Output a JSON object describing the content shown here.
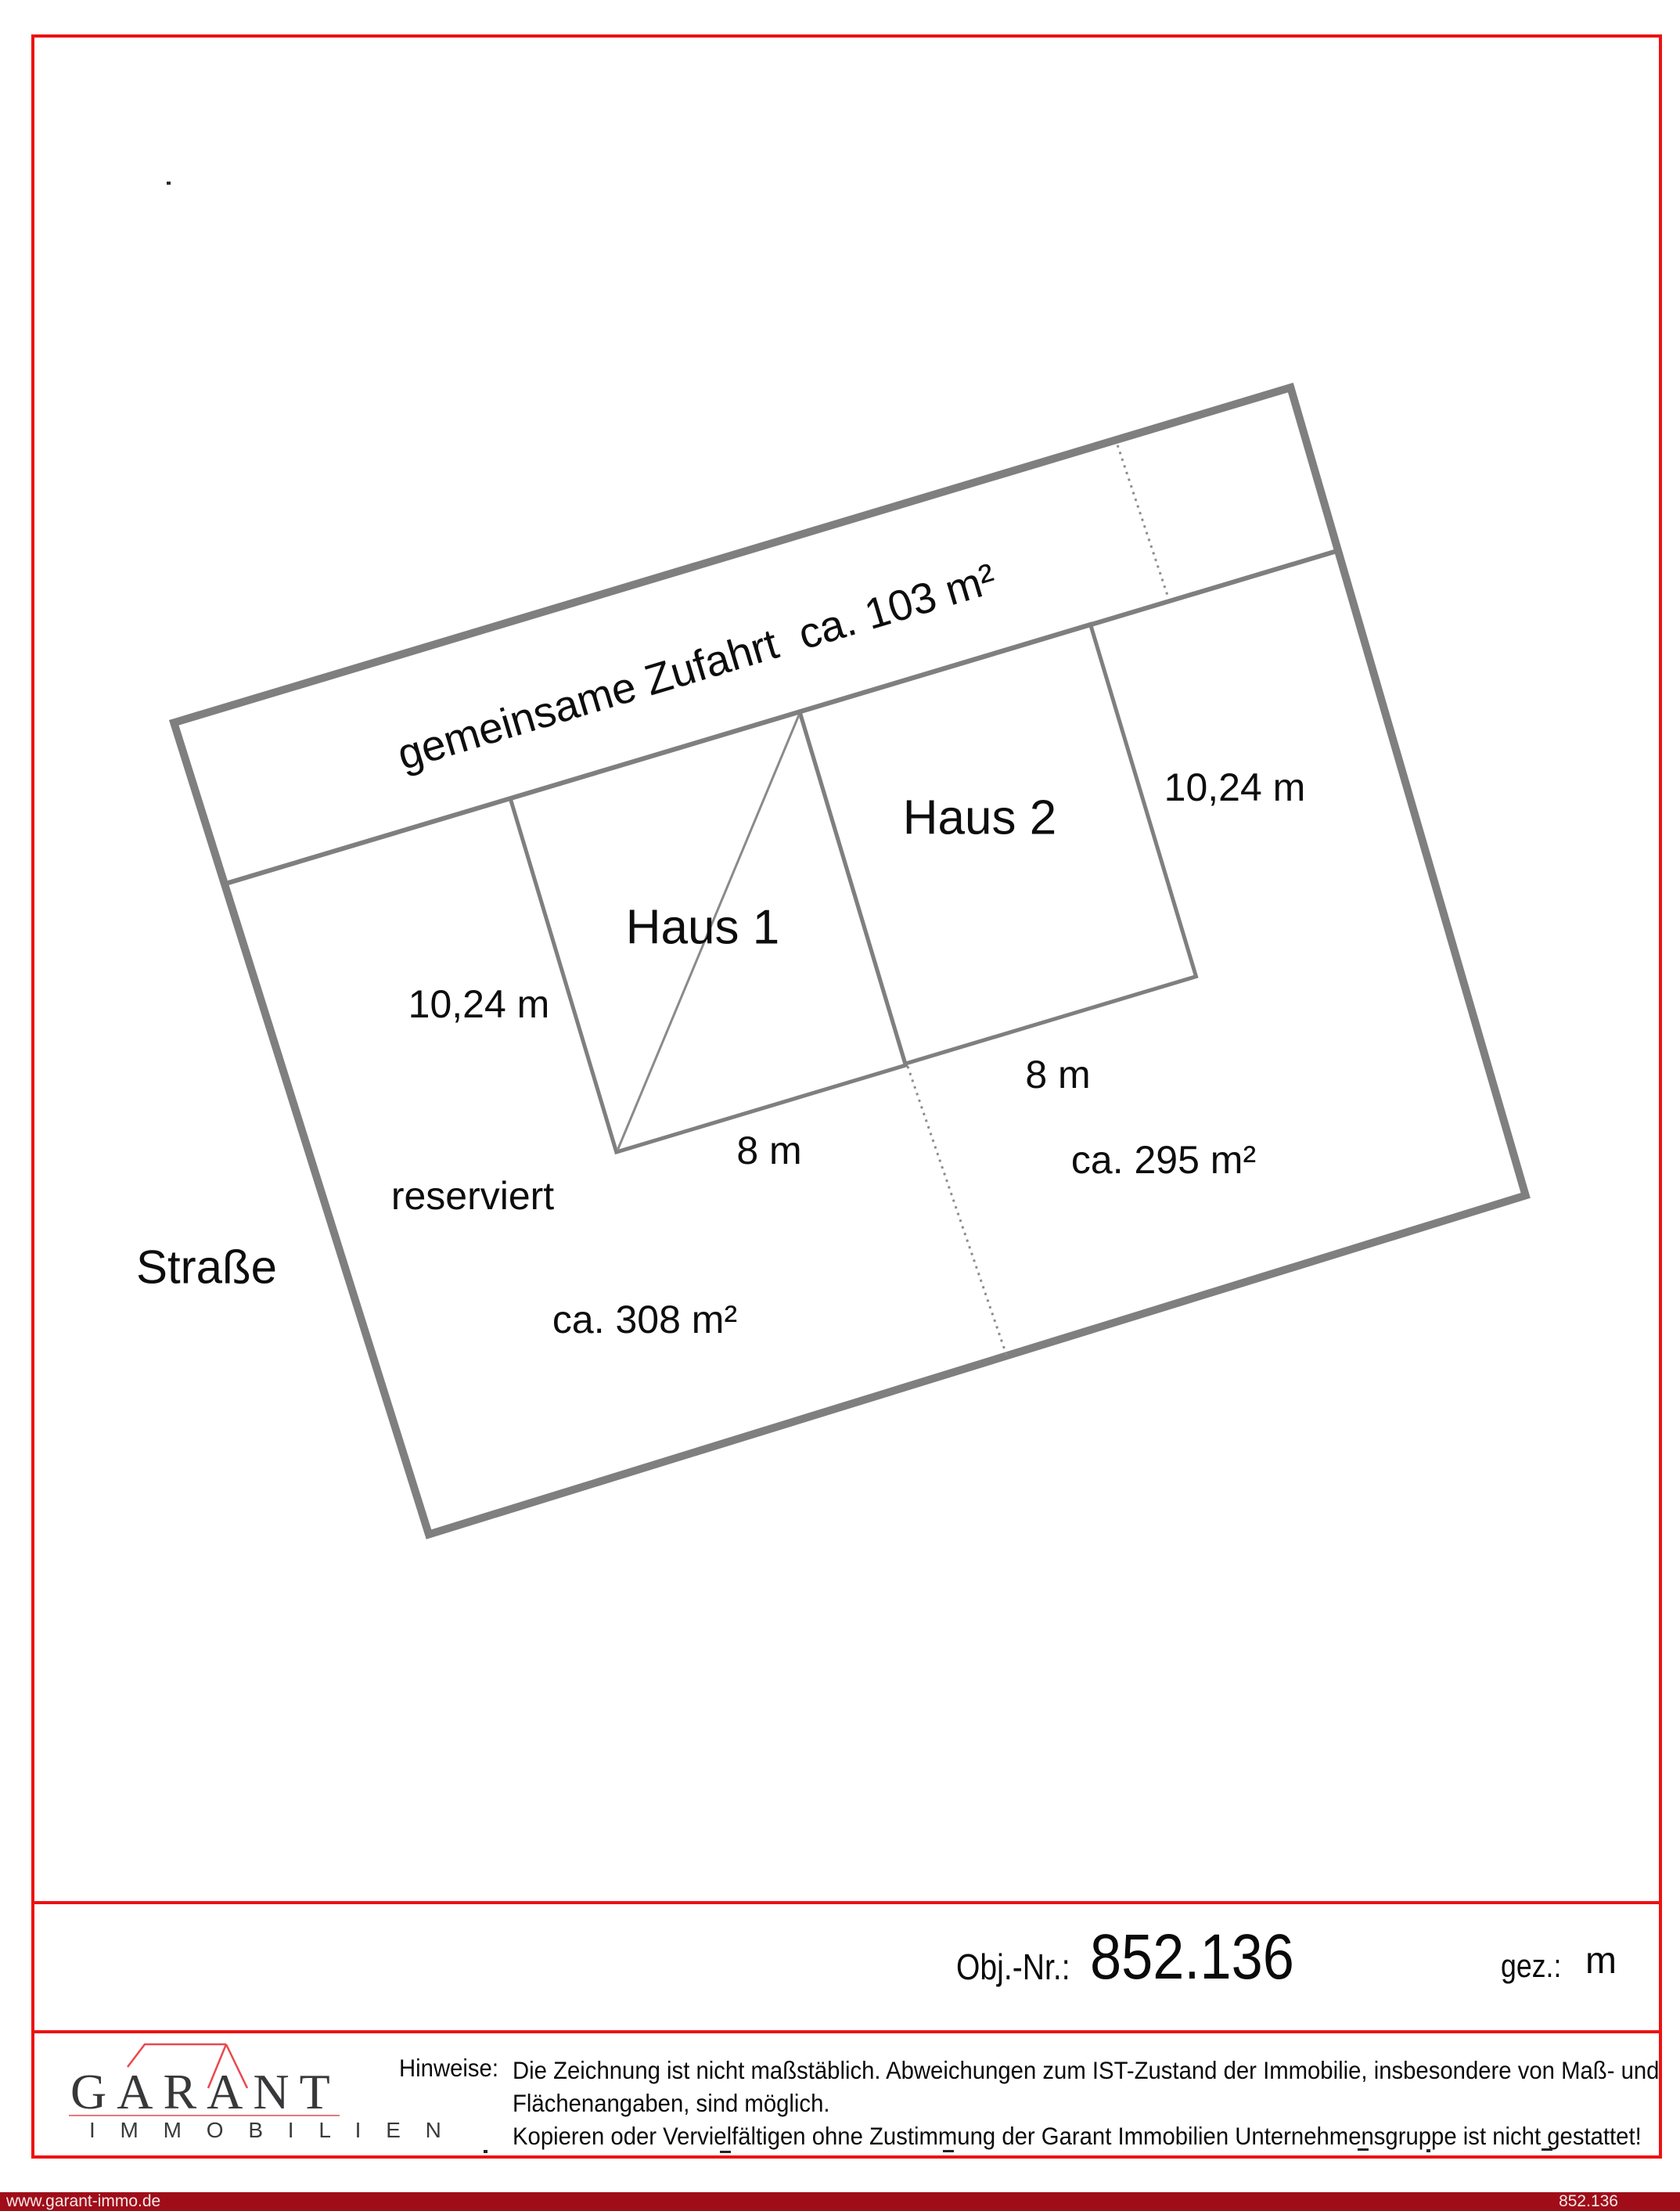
{
  "colors": {
    "frame_red": "#ec1212",
    "bar_dark_red": "#a00d18",
    "plan_line_gray": "#7f7f7f",
    "logo_roof_red": "#e9494e"
  },
  "plan": {
    "labels": {
      "driveway": "gemeinsame Zufahrt  ca. 103 m²",
      "haus1": "Haus 1",
      "haus2": "Haus 2",
      "dim_left": "10,24 m",
      "dim_right": "10,24 m",
      "dim_8_right": "8 m",
      "dim_8_bottom": "8 m",
      "area_right": "ca. 295 m²",
      "area_left": "ca. 308 m²",
      "reserved": "reserviert",
      "street": "Straße"
    }
  },
  "footer": {
    "obj_label": "Obj.-Nr.:",
    "obj_number": "852.136",
    "gez_label": "gez.:",
    "gez_value": "m",
    "logo": {
      "name": "GARANT",
      "sub": "I M M O B I L I E N"
    },
    "notes_label": "Hinweise:",
    "notes_line1": "Die Zeichnung ist nicht maßstäblich. Abweichungen zum IST-Zustand der Immobilie, insbesondere von Maß- und",
    "notes_line2": "Flächenangaben, sind möglich.",
    "notes_line3": "Kopieren oder Vervielfältigen ohne Zustimmung der Garant Immobilien Unternehmensgruppe ist nicht gestattet!",
    "bar_left": "www.garant-immo.de",
    "bar_right": "852.136"
  }
}
